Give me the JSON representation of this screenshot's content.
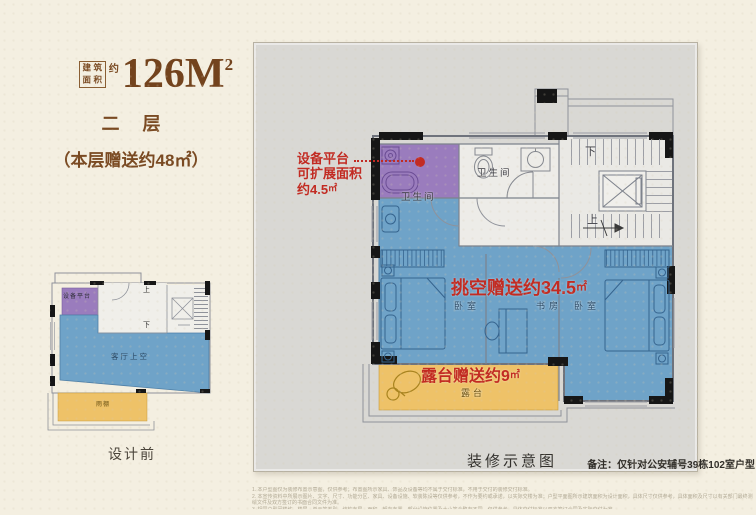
{
  "header": {
    "seal": [
      "建",
      "筑",
      "面",
      "积"
    ],
    "approx": "约",
    "area_value": "126M",
    "area_sup": "2",
    "floor_label": "二 层",
    "floor_bonus": "（本层赠送约48㎡）"
  },
  "mini_plan": {
    "equipment_platform": "设备平台",
    "up": "上",
    "down": "下",
    "living_void": "客厅上空",
    "rain_canopy": "雨棚",
    "caption": "设计前"
  },
  "main_plan": {
    "equipment_note": {
      "line1": "设备平台",
      "line2": "可扩展面积",
      "line3_value": "约4.5",
      "line3_unit": "㎡"
    },
    "bath_left": "卫生间",
    "bath_mid": "卫生间",
    "down": "下",
    "up": "上",
    "void_bonus_value": "挑空赠送约34.5",
    "void_bonus_unit": "㎡",
    "bedroom_left": "卧室",
    "study": "书房",
    "bedroom_right": "卧室",
    "terrace_bonus_value": "露台赠送约9",
    "terrace_bonus_unit": "㎡",
    "terrace": "露台",
    "caption": "装修示意图",
    "note": "备注：仅针对公安辅号39栋102室户型"
  },
  "disclaimer": [
    "1. 本户型图仅为装修布置示意图，仅供参考；布置图所示家具、饰品及设备等均不属于交付标准，不用于交付的装修交付标准。",
    "2. 本宣传资料中所展示图片、文字、尺寸、功能分区、家具、设备设施、软装陈设等仅供参考，不作为要约或承诺，以实际交楼为准；户型平面图所示建筑面积为设计面积，具体尺寸仅供参考，具体面积及尺寸以有关部门最终测绘文件及双方签订的书面合同文件为准。",
    "3. 相同户型因楼栋、楼层、单元等差别，结构布局、面积、朝向布置、部分设施位置及大小等会略有不同，仅供参考，具体交付标准以双方签订合同及实际交付为准。"
  ],
  "colors": {
    "accent_red": "#c22b22",
    "brand_brown": "#7a4a22",
    "fill_blue": "#6fa3c8",
    "fill_purple": "#9a7cbd",
    "fill_orange": "#eec268",
    "panel_gray": "#d9d8d4"
  }
}
